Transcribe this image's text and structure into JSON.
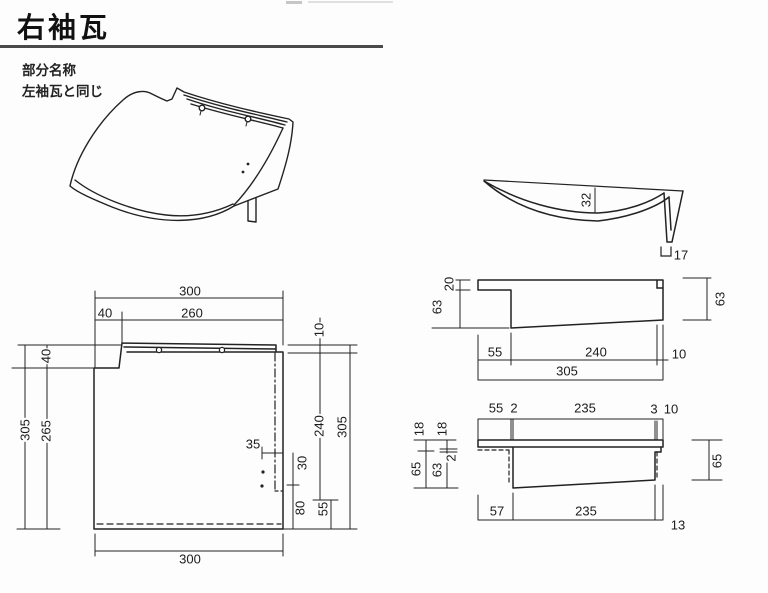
{
  "appearance": {
    "background": "#fdfdfd",
    "line_color": "#222222",
    "rule_color": "#4a4a4a"
  },
  "header": {
    "title": "右袖瓦"
  },
  "notes": {
    "line1": "部分名称",
    "line2": "左袖瓦と同じ"
  },
  "plan": {
    "top_overall": "300",
    "top_left": "40",
    "top_right": "260",
    "left_overall": "305",
    "left_upper": "40",
    "left_lower": "265",
    "right_rib": "10",
    "right_upper": "240",
    "right_overall": "305",
    "notch_w": "35",
    "notch_h": "30",
    "right_lower": "80",
    "right_corner": "55",
    "bottom_overall": "300"
  },
  "section": {
    "curve_depth": "32",
    "leg_width": "17"
  },
  "side_a": {
    "left_top": "20",
    "left_main": "63",
    "right": "63",
    "b1": "55",
    "b2": "240",
    "b3": "10",
    "b_total": "305"
  },
  "side_b": {
    "t1": "55",
    "t2": "2",
    "t3": "235",
    "t4": "3",
    "t5": "10",
    "l_out_top": "18",
    "l_in_top": "18",
    "l_in_small": "2",
    "l_in": "63",
    "l_out": "65",
    "right": "65",
    "b1": "57",
    "b2": "235",
    "b3": "13"
  }
}
